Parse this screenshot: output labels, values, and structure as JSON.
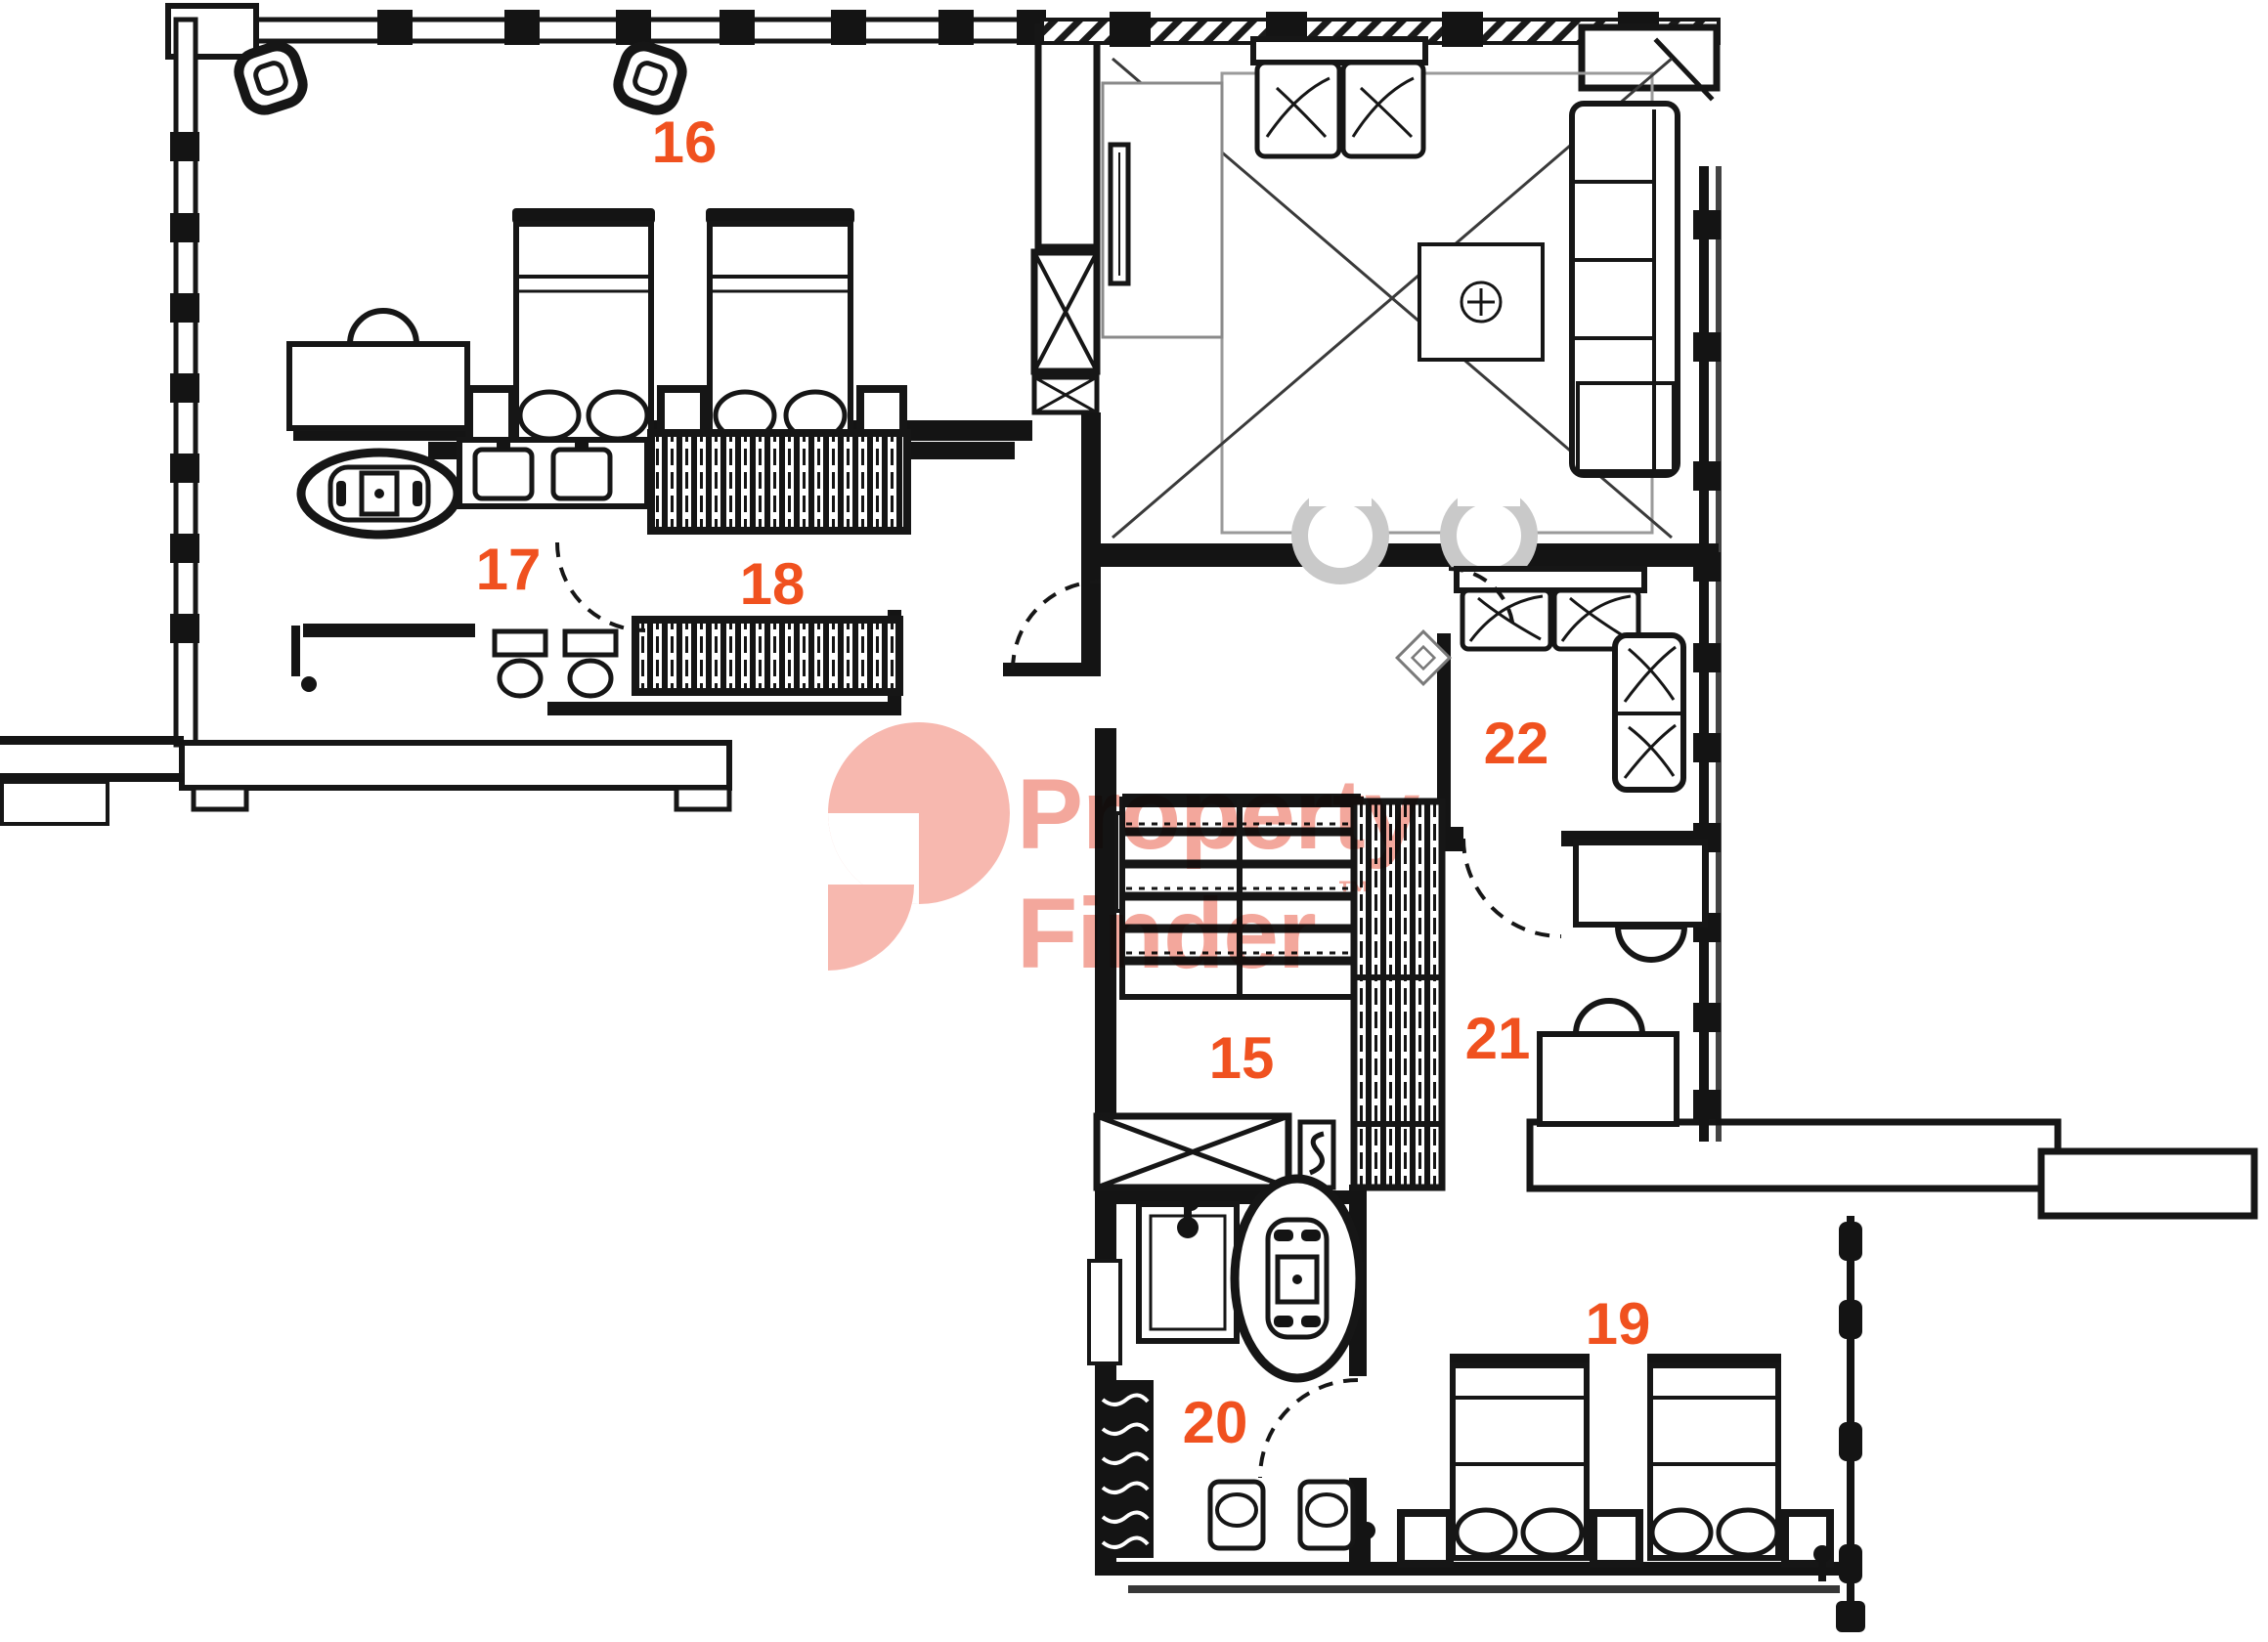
{
  "plan": {
    "type": "apartment-floor-plan",
    "background": "#ffffff",
    "line_color": "#161616",
    "label_color": "#F0511F",
    "watermark": {
      "line1": "Property",
      "line2": "Finder",
      "trademark": "™",
      "color": "#F19486",
      "logo_color": "#F6A99E"
    },
    "rooms": [
      {
        "number": "16",
        "furniture": [
          "twin-bed",
          "twin-bed",
          "nightstand",
          "nightstand",
          "nightstand",
          "dresser",
          "ceiling-speaker",
          "ceiling-speaker"
        ]
      },
      {
        "number": "17",
        "furniture": [
          "bathtub",
          "double-vanity",
          "toilet",
          "bidet"
        ]
      },
      {
        "number": "18",
        "furniture": [
          "wardrobe",
          "wardrobe"
        ]
      },
      {
        "number": "15",
        "furniture": [
          "staircase",
          "elevator",
          "wardrobe-closet"
        ]
      },
      {
        "number": "19",
        "furniture": [
          "twin-bed",
          "twin-bed",
          "nightstand",
          "nightstand",
          "nightstand"
        ]
      },
      {
        "number": "20",
        "furniture": [
          "shower",
          "bathtub",
          "washbasin",
          "washbasin",
          "linen-cabinet"
        ]
      },
      {
        "number": "21",
        "furniture": [
          "desk",
          "chair",
          "desk",
          "chair"
        ]
      },
      {
        "number": "22",
        "furniture": [
          "sofa",
          "armchair"
        ]
      }
    ],
    "living_area_furniture": [
      "sofa",
      "sectional-sofa",
      "coffee-table",
      "barrel-chair",
      "barrel-chair",
      "side-table",
      "tv-console",
      "rug"
    ]
  }
}
